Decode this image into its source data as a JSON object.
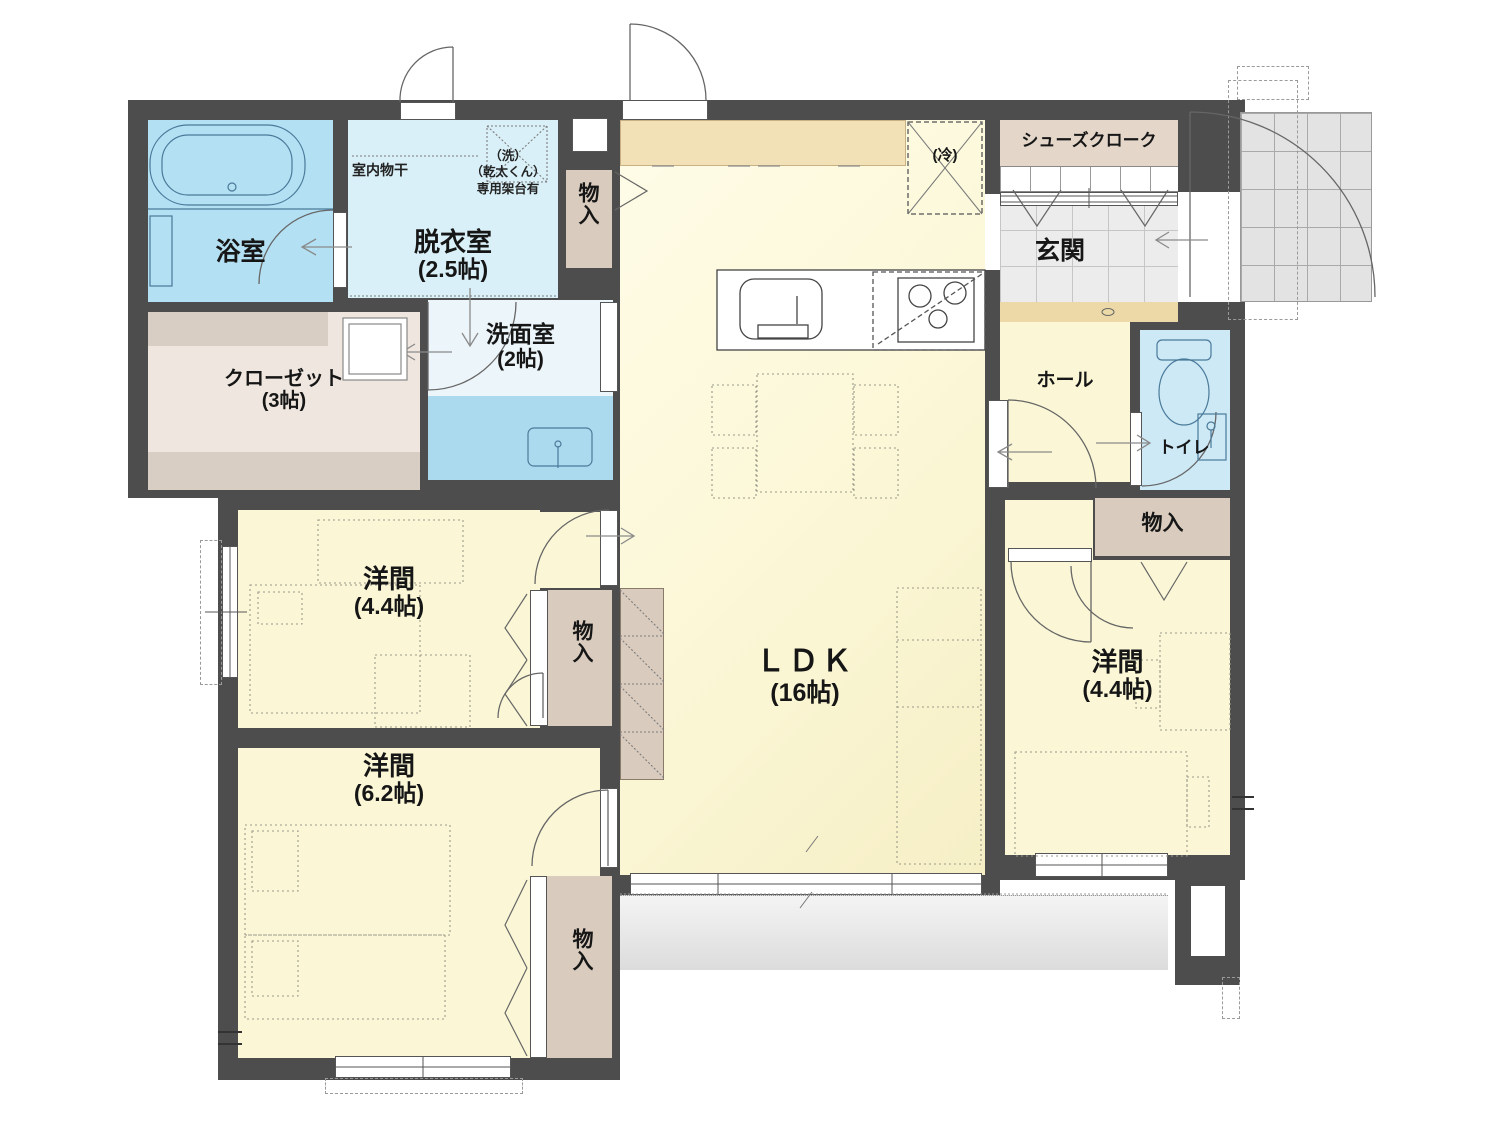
{
  "title": "1F 間取り図",
  "colors": {
    "wall": "#4d4d4d",
    "roomYellow": "#fbf7d6",
    "bathBlue": "#b3e0f2",
    "dressingBlue": "#d9f0f8",
    "vanityBlue": "#abdaee",
    "toiletBlue": "#cde9f6",
    "tan": "#d9cbbd",
    "counterTan": "#f2e0b6",
    "stepTan": "#edd9a8",
    "shoeTan": "#e4d7ca"
  },
  "rooms": {
    "bath": {
      "name": "浴室"
    },
    "dressing": {
      "name": "脱衣室",
      "size": "(2.5帖)"
    },
    "washroom": {
      "name": "洗面室",
      "size": "(2帖)"
    },
    "closet": {
      "name": "クローゼット",
      "size": "(3帖)"
    },
    "ldk": {
      "name": "ＬＤＫ",
      "size": "(16帖)"
    },
    "entrance": {
      "name": "玄関"
    },
    "shoe_cloak": {
      "name": "シューズクローク"
    },
    "hall": {
      "name": "ホール"
    },
    "toilet": {
      "name": "トイレ"
    },
    "west_room_left": {
      "name": "洋間",
      "size": "(4.4帖)"
    },
    "west_room_bottom": {
      "name": "洋間",
      "size": "(6.2帖)"
    },
    "west_room_right": {
      "name": "洋間",
      "size": "(4.4帖)"
    },
    "storage_top": {
      "name": "物入"
    },
    "storage_mid": {
      "name": "物入"
    },
    "storage_bottom": {
      "name": "物入"
    },
    "storage_right": {
      "name": "物入"
    }
  },
  "annotations": {
    "indoor_clothes_pole": "室内物干",
    "washer_line1": "（洗）",
    "washer_line2": "（乾太くん）",
    "washer_line3": "専用架台有",
    "fridge": "(冷)"
  }
}
